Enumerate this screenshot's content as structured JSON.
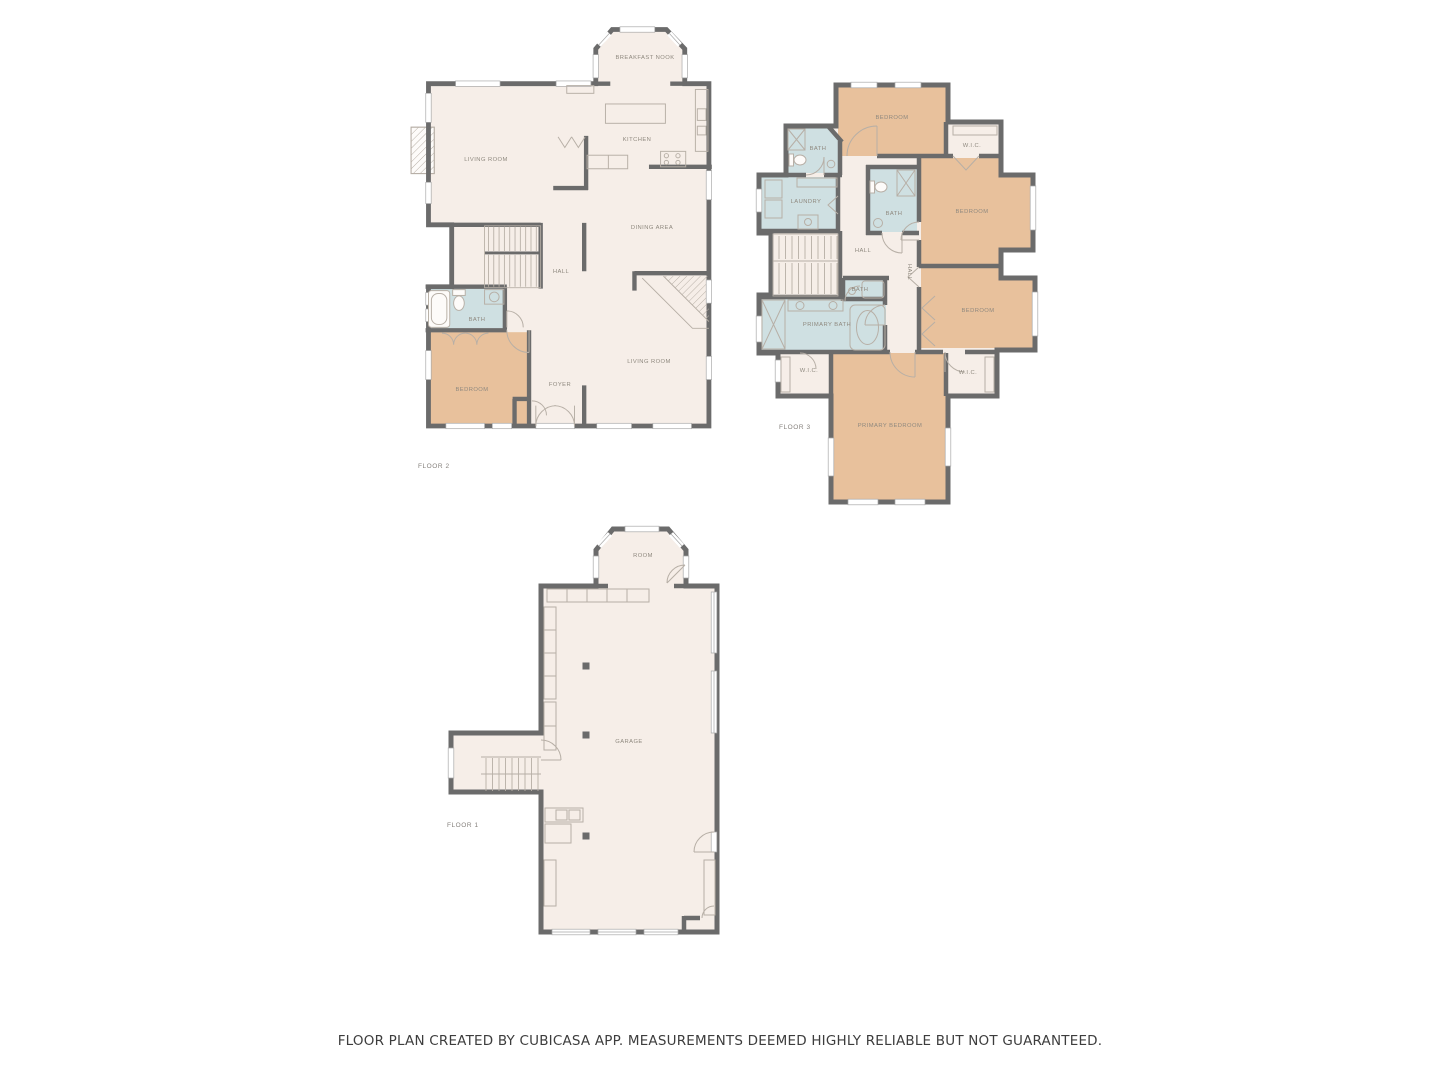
{
  "palette": {
    "wall": "#6b6b6b",
    "floor": "#f6eee8",
    "bed": "#e8c19c",
    "bath": "#cfe0e2",
    "line": "#b7afa6",
    "label": "#8f897f",
    "floorlabel": "#85817c",
    "footer": "#3d3d3d",
    "bg": "#ffffff"
  },
  "floors": [
    {
      "id": "floor-2",
      "label": "FLOOR 2",
      "rooms": [
        "BREAKFAST NOOK",
        "KITCHEN",
        "LIVING ROOM",
        "DINING AREA",
        "HALL",
        "BATH",
        "BEDROOM",
        "FOYER",
        "LIVING ROOM"
      ]
    },
    {
      "id": "floor-3",
      "label": "FLOOR 3",
      "rooms": [
        "BEDROOM",
        "BATH",
        "W.I.C.",
        "LAUNDRY",
        "BATH",
        "BEDROOM",
        "HALL",
        "HALL",
        "BATH",
        "PRIMARY BATH",
        "BEDROOM",
        "W.I.C.",
        "W.I.C.",
        "PRIMARY BEDROOM"
      ]
    },
    {
      "id": "floor-1",
      "label": "FLOOR 1",
      "rooms": [
        "ROOM",
        "GARAGE"
      ]
    }
  ],
  "footer": {
    "text": "FLOOR PLAN CREATED BY CUBICASA APP. MEASUREMENTS DEEMED HIGHLY RELIABLE BUT NOT GUARANTEED."
  }
}
